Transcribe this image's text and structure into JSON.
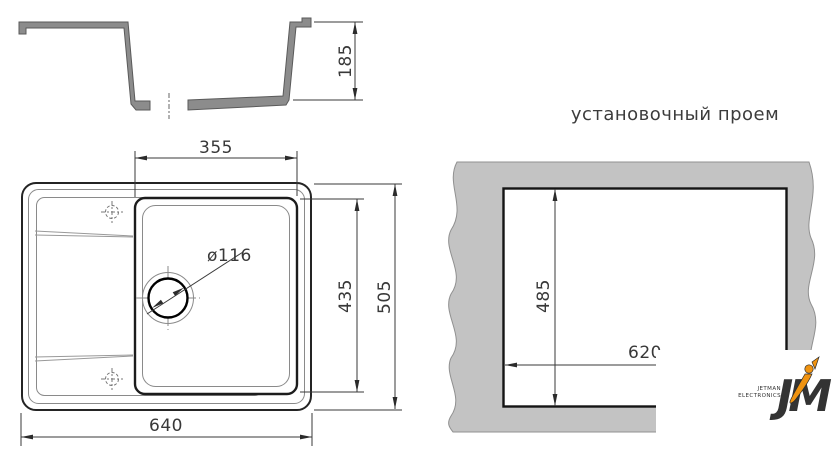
{
  "drawing": {
    "section_view": {
      "depth": "185"
    },
    "plan_view": {
      "bowl_width": "355",
      "bowl_depth": "435",
      "overall_depth": "505",
      "overall_width": "640",
      "drain_diameter": "ø116"
    },
    "cutout_view": {
      "title": "установочный проем",
      "cutout_height": "485",
      "cutout_width": "620"
    }
  },
  "watermark": {
    "brand_top": "JETMAN",
    "brand_bottom": "ELECTRONICS",
    "monogram": "JM"
  },
  "colors": {
    "section_fill": "#8c8c8c",
    "countertop_fill": "#c3c3c3",
    "line_dark": "#2a2a2a",
    "logo_dark": "#17171f",
    "accent_orange": "#f09310"
  }
}
